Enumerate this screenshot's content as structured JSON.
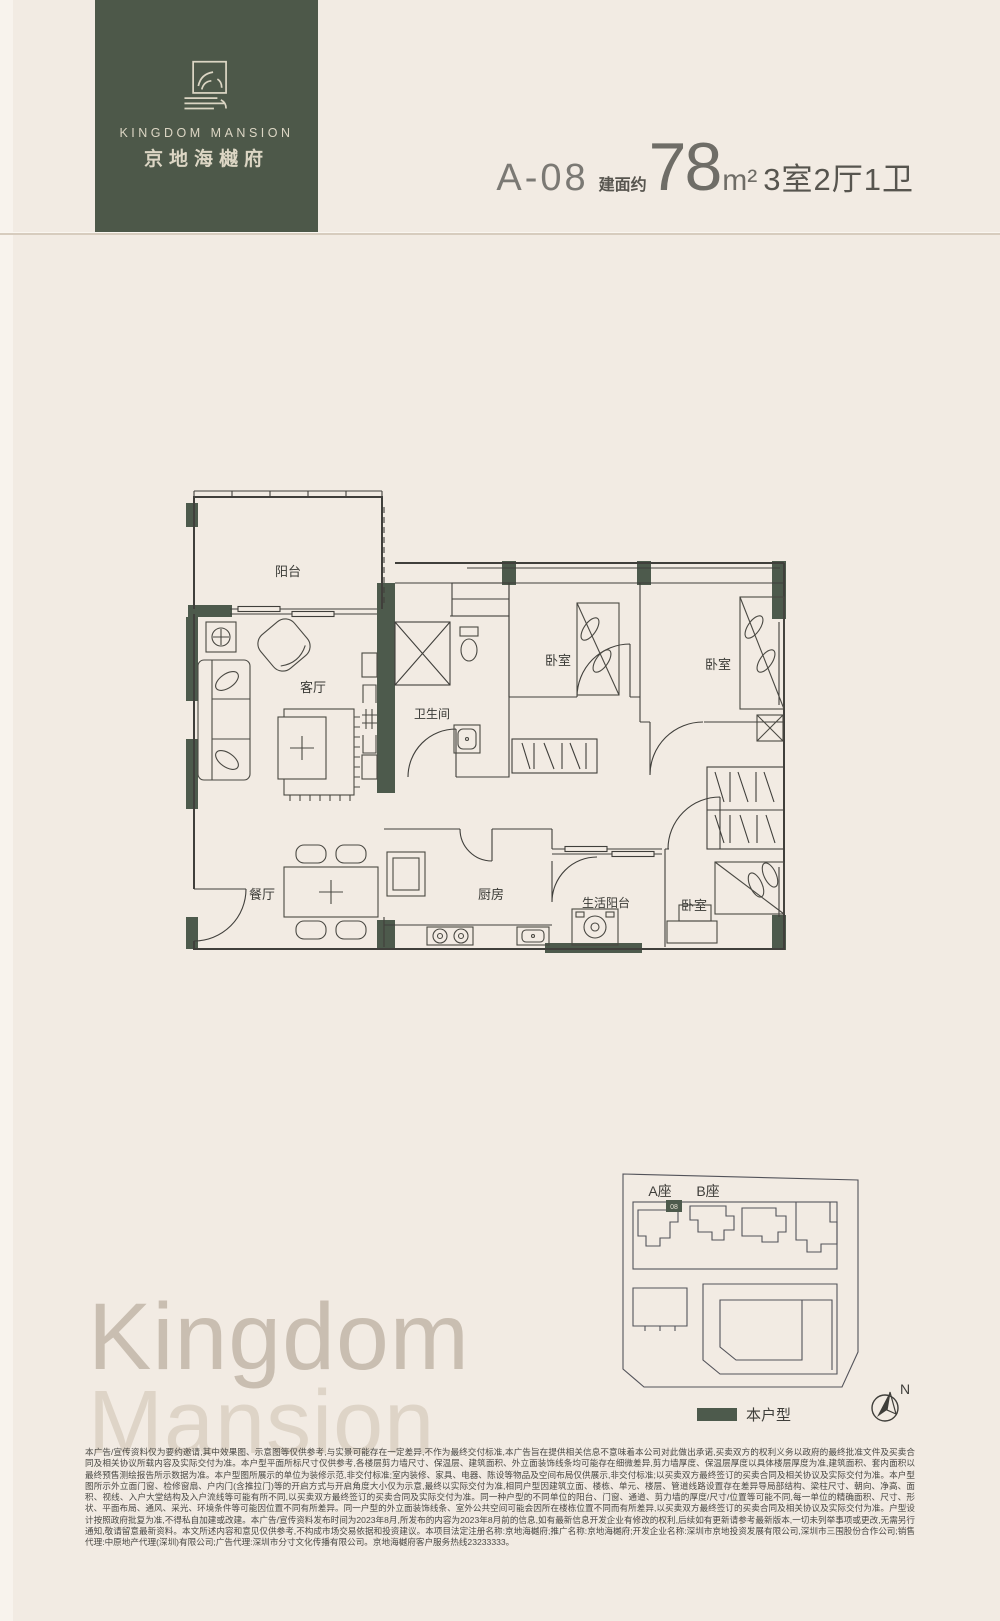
{
  "brand": {
    "logo_en": "KINGDOM MANSION",
    "logo_cn": "京地海樾府"
  },
  "header": {
    "unit": "A-08",
    "area_label": "建面约",
    "area_value": "78",
    "area_unit": "m²",
    "layout": "3室2厅1卫"
  },
  "floorplan": {
    "labels": {
      "balcony": "阳台",
      "living": "客厅",
      "bathroom": "卫生间",
      "bedroom1": "卧室",
      "bedroom2": "卧室",
      "dining": "餐厅",
      "kitchen": "厨房",
      "service_balcony": "生活阳台",
      "bedroom3": "卧室"
    }
  },
  "siteplan": {
    "tower_a": "A座",
    "tower_b": "B座",
    "unit_marker": "08",
    "legend_label": "本户型",
    "compass_label": "N"
  },
  "watermark": {
    "line1": "Kingdom",
    "line2": "Mansion"
  },
  "disclaimer": {
    "text": "本广告/宣传资料仅为要约邀请,其中效果图、示意图等仅供参考,与实景可能存在一定差异,不作为最终交付标准,本广告旨在提供相关信息不意味着本公司对此做出承诺,买卖双方的权利义务以政府的最终批准文件及买卖合同及相关协议所载内容及实际交付为准。本户型平面所标尺寸仅供参考,各楼层剪力墙尺寸、保温层、建筑面积、外立面装饰线条均可能存在细微差异,剪力墙厚度、保温层厚度以具体楼层厚度为准,建筑面积、套内面积以最终预售测绘报告所示数据为准。本户型图所展示的单位为装修示范,非交付标准;室内装修、家具、电器、陈设等物品及空间布局仅供展示,非交付标准;以买卖双方最终签订的买卖合同及相关协议及实际交付为准。本户型图所示外立面门窗、检修窗扇、户内门(含推拉门)等的开启方式与开启角度大小仅为示意,最终以实际交付为准,相同户型因建筑立面、楼栋、单元、楼层、管道线路设置存在差异导局部结构、梁柱尺寸、朝向、净高、面积、视线、入户大堂结构及入户流线等可能有所不同,以买卖双方最终签订的买卖合同及实际交付为准。同一种户型的不同单位的阳台、门窗、通道、剪力墙的厚度/尺寸/位置等可能不同,每一单位的精确面积、尺寸、形状、平面布局、通风、采光、环境条件等可能因位置不同有所差异。同一户型的外立面装饰线条、室外公共空间可能会因所在楼栋位置不同而有所差异,以买卖双方最终签订的买卖合同及相关协议及实际交付为准。户型设计按照政府批复为准,不得私自加建或改建。本广告/宣传资料发布时间为2023年8月,所发布的内容为2023年8月前的信息,如有最新信息开发企业有修改的权利,后续如有更新请参考最新版本,一切未列举事项或更改,无需另行通知,敬请留意最新资料。本文所述内容和意见仅供参考,不构成市场交易依据和投资建议。本项目法定注册名称:京地海樾府;推广名称:京地海樾府;开发企业名称:深圳市京地投资发展有限公司,深圳市三围股份合作公司;销售代理:中原地产代理(深圳)有限公司;广告代理:深圳市分寸文化传播有限公司。京地海樾府客户服务热线23233333。"
  },
  "colors": {
    "brand_green": "#4d5849",
    "wall_green": "#4d5a4c",
    "background": "#f2ebe3"
  }
}
